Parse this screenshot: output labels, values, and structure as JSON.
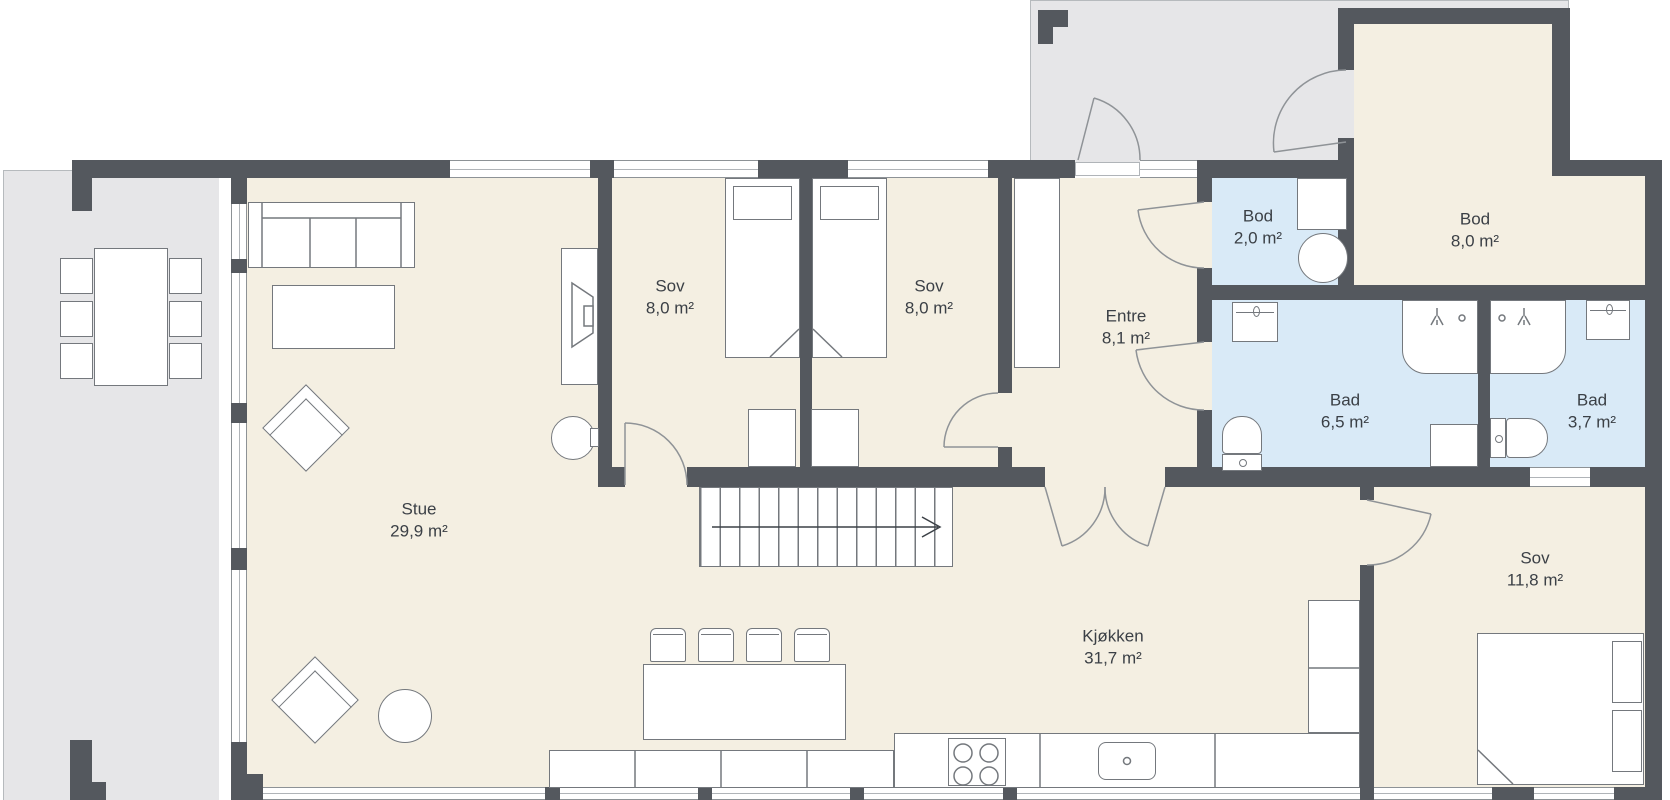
{
  "plan_title": "Floor plan – first floor",
  "rooms": {
    "stue": {
      "name": "Stue",
      "area": "29,9 m²"
    },
    "sov1": {
      "name": "Sov",
      "area": "8,0 m²"
    },
    "sov2": {
      "name": "Sov",
      "area": "8,0 m²"
    },
    "entre": {
      "name": "Entre",
      "area": "8,1 m²"
    },
    "bod_small": {
      "name": "Bod",
      "area": "2,0 m²"
    },
    "bod_large": {
      "name": "Bod",
      "area": "8,0 m²"
    },
    "bad_large": {
      "name": "Bad",
      "area": "6,5 m²"
    },
    "bad_small": {
      "name": "Bad",
      "area": "3,7 m²"
    },
    "kjokken": {
      "name": "Kjøkken",
      "area": "31,7 m²"
    },
    "sov3": {
      "name": "Sov",
      "area": "11,8 m²"
    }
  },
  "colors": {
    "wall": "#54585e",
    "floor_dry": "#f4efe2",
    "floor_wet": "#d9eaf7",
    "outdoor": "#e6e6e8",
    "furniture_outline": "#74787d",
    "label_text": "#3b4046"
  },
  "furniture_icons": [
    "dining-table",
    "dining-chair",
    "sofa",
    "coffee-table",
    "armchair",
    "side-table",
    "tv-bench",
    "tv",
    "reading-chair",
    "single-bed",
    "double-bed",
    "pillow",
    "wardrobe",
    "closet",
    "stairs-up-arrow",
    "kitchen-island",
    "bar-stool",
    "kitchen-counter",
    "cooktop",
    "kitchen-sink",
    "tall-cabinet",
    "washing-machine",
    "bathroom-sink",
    "shower",
    "toilet",
    "door-swing",
    "window"
  ]
}
